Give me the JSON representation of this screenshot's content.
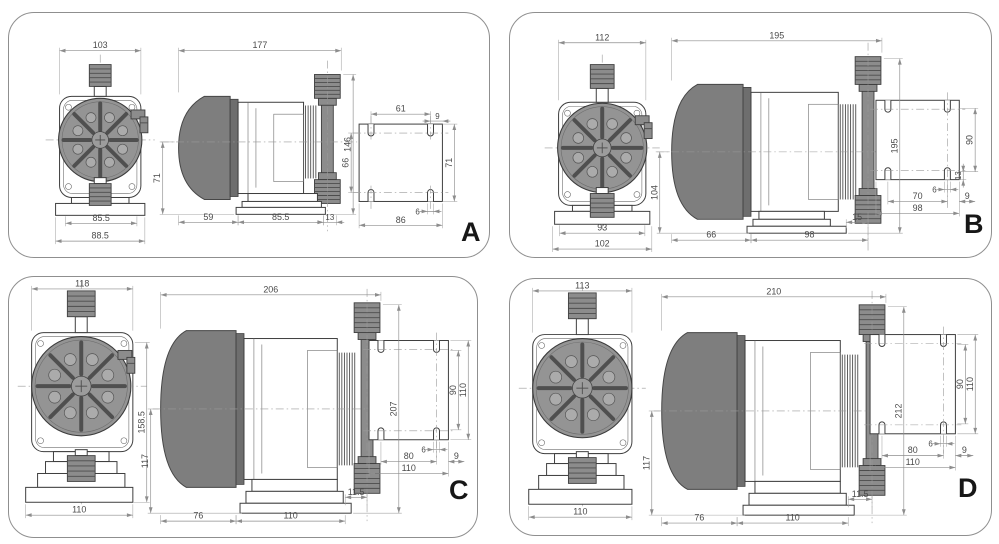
{
  "panels": [
    {
      "letter": "A",
      "front": {
        "width_top": "103",
        "width_base_inner": "85.5",
        "width_base_outer": "88.5"
      },
      "side": {
        "length_top": "177",
        "height_left": "71",
        "height_right": "146",
        "bottom": [
          "59",
          "85.5",
          "13"
        ]
      },
      "plate": {
        "holes_top": "61",
        "offset_top": "9",
        "holes_left": "66",
        "height_right": "71",
        "slot_width": "6",
        "width_bottom": "86"
      }
    },
    {
      "letter": "B",
      "front": {
        "width_top": "112",
        "width_base_inner": "93",
        "width_base_outer": "102"
      },
      "side": {
        "length_top": "195",
        "height_left": "104",
        "height_right": "195",
        "bottom": [
          "66",
          "98"
        ],
        "offset_right": "15"
      },
      "plate": {
        "holes_right": "90",
        "edge_right": "13",
        "slot_width": "6",
        "holes_bottom": "70",
        "width_bottom": "98",
        "offset_right": "9"
      }
    },
    {
      "letter": "C",
      "front": {
        "width_top": "118",
        "width_base": "110",
        "height_right": "158.5"
      },
      "side": {
        "length_top": "206",
        "height_left": "117",
        "height_right": "207",
        "bottom": [
          "76",
          "110"
        ],
        "offset_right": "11.5"
      },
      "plate": {
        "holes_right": "90",
        "height_outer": "110",
        "slot_width": "6",
        "holes_bottom": "80",
        "width_bottom": "110",
        "offset_right": "9"
      }
    },
    {
      "letter": "D",
      "front": {
        "width_top": "113",
        "width_base": "110"
      },
      "side": {
        "length_top": "210",
        "height_left": "117",
        "height_right": "212",
        "bottom": [
          "76",
          "110"
        ],
        "offset_right": "11.5"
      },
      "plate": {
        "holes_right": "90",
        "height_outer": "110",
        "slot_width": "6",
        "holes_bottom": "80",
        "width_bottom": "110",
        "offset_right": "9"
      }
    }
  ]
}
